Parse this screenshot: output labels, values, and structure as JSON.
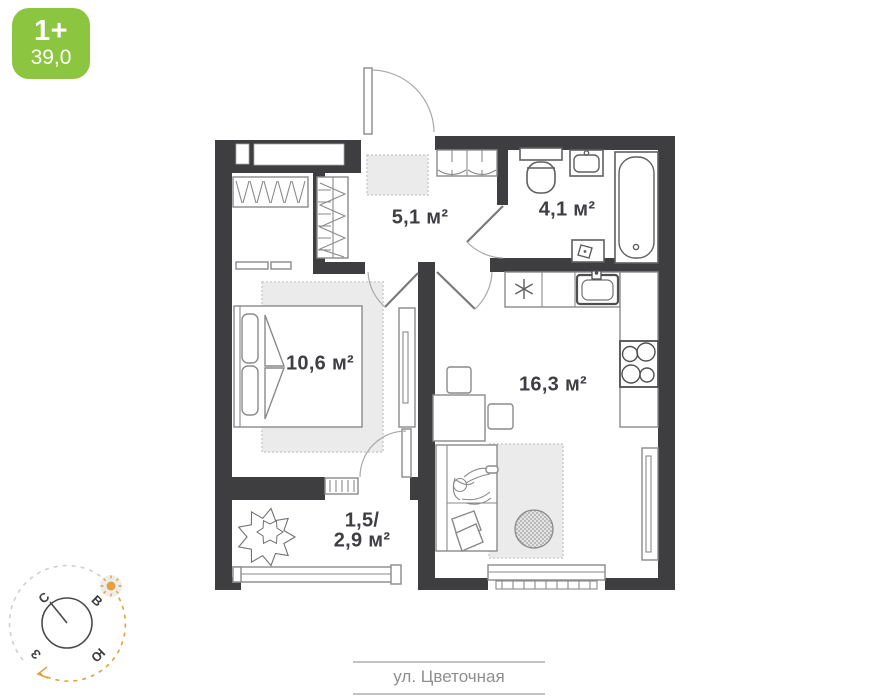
{
  "badge": {
    "rooms": "1+",
    "area": "39,0"
  },
  "rooms": {
    "hallway": {
      "area": "5,1 м²"
    },
    "bathroom": {
      "area": "4,1 м²"
    },
    "bedroom": {
      "area": "10,6 м²"
    },
    "kitchen_living": {
      "area": "16,3 м²"
    },
    "balcony": {
      "area_line1": "1,5/",
      "area_line2": "2,9 м²"
    }
  },
  "compass": {
    "north": "С",
    "east": "В",
    "south": "Ю",
    "west": "З"
  },
  "street": {
    "label": "ул. Цветочная"
  },
  "colors": {
    "badge_green": "#8cc540",
    "wall_dark": "#3e3e41",
    "accent_orange": "#e2a23c"
  }
}
